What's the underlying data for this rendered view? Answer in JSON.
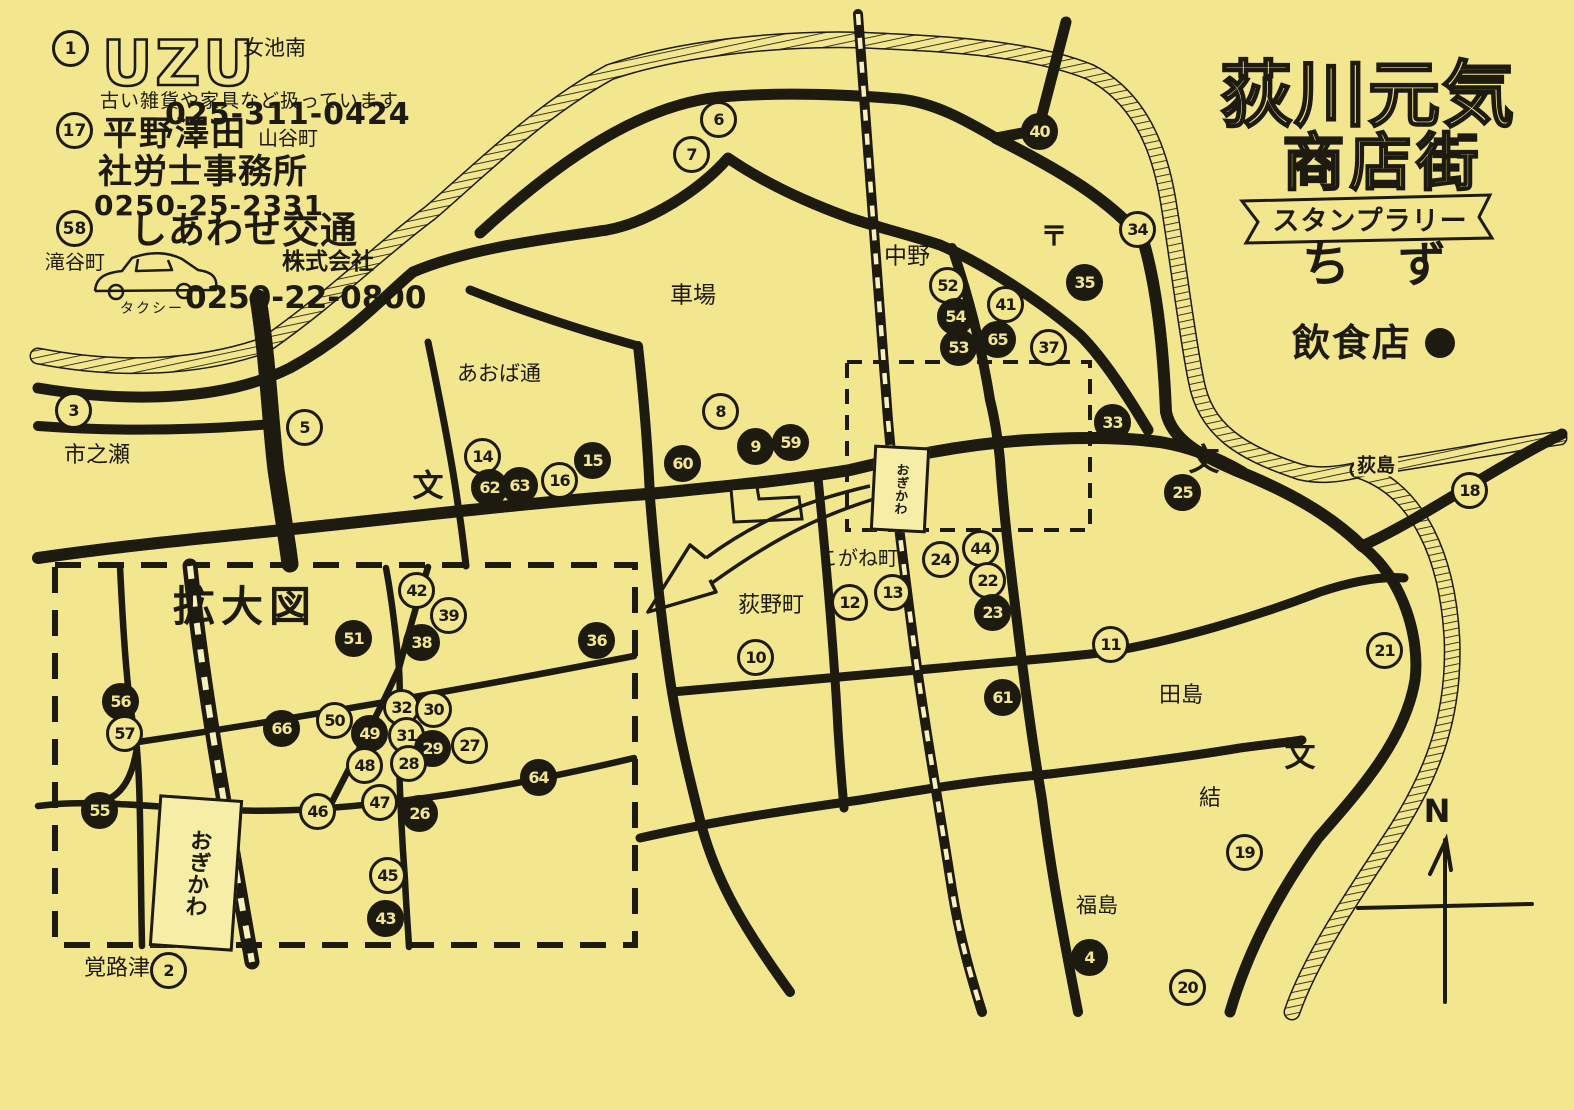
{
  "colors": {
    "paper": "#f2e68f",
    "ink": "#1d1a10"
  },
  "title": {
    "line1": "荻川元気",
    "line2": "商店街",
    "banner": "スタンプラリー",
    "map_word": "ち　ず",
    "food_legend": "飲食店"
  },
  "compass": {
    "letter": "N"
  },
  "station_main": "おぎかわ",
  "station_inset": "おぎかわ",
  "ads": [
    {
      "number": "1",
      "logo": "UZU",
      "area": "女池南",
      "desc": "古い雑貨や家具など扱っています",
      "phone": "025-311-0424"
    },
    {
      "number": "17",
      "name": "平野澤田",
      "area": "山谷町",
      "name2": "社労士事務所",
      "phone": "0250-25-2331"
    },
    {
      "number": "58",
      "name": "しあわせ交通",
      "name2": "株式会社",
      "area": "滝谷町",
      "vehicle": "タクシー",
      "phone": "0250-22-0800"
    }
  ],
  "markers": [
    {
      "n": "3",
      "x": 72,
      "y": 409,
      "filled": false
    },
    {
      "n": "5",
      "x": 303,
      "y": 426,
      "filled": false
    },
    {
      "n": "6",
      "x": 717,
      "y": 118,
      "filled": false
    },
    {
      "n": "7",
      "x": 690,
      "y": 153,
      "filled": false
    },
    {
      "n": "40",
      "x": 1038,
      "y": 130,
      "filled": true
    },
    {
      "n": "34",
      "x": 1136,
      "y": 228,
      "filled": false
    },
    {
      "n": "35",
      "x": 1083,
      "y": 281,
      "filled": true
    },
    {
      "n": "52",
      "x": 946,
      "y": 284,
      "filled": false
    },
    {
      "n": "54",
      "x": 954,
      "y": 315,
      "filled": true
    },
    {
      "n": "53",
      "x": 957,
      "y": 346,
      "filled": true
    },
    {
      "n": "41",
      "x": 1004,
      "y": 303,
      "filled": false
    },
    {
      "n": "65",
      "x": 996,
      "y": 338,
      "filled": true
    },
    {
      "n": "37",
      "x": 1047,
      "y": 346,
      "filled": false
    },
    {
      "n": "8",
      "x": 719,
      "y": 410,
      "filled": false
    },
    {
      "n": "14",
      "x": 481,
      "y": 455,
      "filled": false
    },
    {
      "n": "62",
      "x": 488,
      "y": 486,
      "filled": true
    },
    {
      "n": "63",
      "x": 518,
      "y": 484,
      "filled": true
    },
    {
      "n": "16",
      "x": 558,
      "y": 479,
      "filled": false
    },
    {
      "n": "15",
      "x": 591,
      "y": 459,
      "filled": true
    },
    {
      "n": "60",
      "x": 681,
      "y": 462,
      "filled": true
    },
    {
      "n": "9",
      "x": 754,
      "y": 445,
      "filled": true
    },
    {
      "n": "59",
      "x": 789,
      "y": 441,
      "filled": true
    },
    {
      "n": "33",
      "x": 1111,
      "y": 421,
      "filled": true
    },
    {
      "n": "25",
      "x": 1181,
      "y": 491,
      "filled": true
    },
    {
      "n": "18",
      "x": 1468,
      "y": 489,
      "filled": false
    },
    {
      "n": "44",
      "x": 979,
      "y": 547,
      "filled": false
    },
    {
      "n": "24",
      "x": 939,
      "y": 558,
      "filled": false
    },
    {
      "n": "22",
      "x": 986,
      "y": 579,
      "filled": false
    },
    {
      "n": "23",
      "x": 991,
      "y": 611,
      "filled": true
    },
    {
      "n": "13",
      "x": 891,
      "y": 591,
      "filled": false
    },
    {
      "n": "12",
      "x": 848,
      "y": 601,
      "filled": false
    },
    {
      "n": "10",
      "x": 754,
      "y": 656,
      "filled": false
    },
    {
      "n": "11",
      "x": 1109,
      "y": 643,
      "filled": false
    },
    {
      "n": "61",
      "x": 1001,
      "y": 696,
      "filled": true
    },
    {
      "n": "21",
      "x": 1383,
      "y": 649,
      "filled": false
    },
    {
      "n": "4",
      "x": 1088,
      "y": 956,
      "filled": true
    },
    {
      "n": "19",
      "x": 1243,
      "y": 851,
      "filled": false
    },
    {
      "n": "20",
      "x": 1186,
      "y": 986,
      "filled": false
    },
    {
      "n": "2",
      "x": 167,
      "y": 969,
      "filled": false
    },
    {
      "n": "42",
      "x": 415,
      "y": 589,
      "filled": false
    },
    {
      "n": "39",
      "x": 447,
      "y": 614,
      "filled": false
    },
    {
      "n": "51",
      "x": 352,
      "y": 637,
      "filled": true
    },
    {
      "n": "38",
      "x": 420,
      "y": 641,
      "filled": true
    },
    {
      "n": "36",
      "x": 595,
      "y": 639,
      "filled": true
    },
    {
      "n": "56",
      "x": 119,
      "y": 700,
      "filled": true
    },
    {
      "n": "57",
      "x": 123,
      "y": 732,
      "filled": false
    },
    {
      "n": "66",
      "x": 280,
      "y": 727,
      "filled": true
    },
    {
      "n": "50",
      "x": 333,
      "y": 719,
      "filled": false
    },
    {
      "n": "49",
      "x": 368,
      "y": 732,
      "filled": true
    },
    {
      "n": "32",
      "x": 400,
      "y": 706,
      "filled": false
    },
    {
      "n": "30",
      "x": 432,
      "y": 708,
      "filled": false
    },
    {
      "n": "31",
      "x": 405,
      "y": 734,
      "filled": false
    },
    {
      "n": "29",
      "x": 431,
      "y": 747,
      "filled": true
    },
    {
      "n": "27",
      "x": 468,
      "y": 744,
      "filled": false
    },
    {
      "n": "28",
      "x": 407,
      "y": 762,
      "filled": false
    },
    {
      "n": "48",
      "x": 363,
      "y": 764,
      "filled": false
    },
    {
      "n": "64",
      "x": 537,
      "y": 776,
      "filled": true
    },
    {
      "n": "46",
      "x": 316,
      "y": 810,
      "filled": false
    },
    {
      "n": "47",
      "x": 378,
      "y": 801,
      "filled": false
    },
    {
      "n": "26",
      "x": 418,
      "y": 812,
      "filled": true
    },
    {
      "n": "45",
      "x": 386,
      "y": 874,
      "filled": false
    },
    {
      "n": "43",
      "x": 384,
      "y": 917,
      "filled": true
    },
    {
      "n": "55",
      "x": 98,
      "y": 809,
      "filled": true
    }
  ],
  "labels": [
    {
      "text": "市之瀬",
      "x": 97,
      "y": 456,
      "size": 22
    },
    {
      "text": "あおば通",
      "x": 499,
      "y": 374,
      "size": 21
    },
    {
      "text": "車場",
      "x": 693,
      "y": 296,
      "size": 23
    },
    {
      "text": "中野",
      "x": 907,
      "y": 257,
      "size": 23
    },
    {
      "text": "〒",
      "x": 1054,
      "y": 237,
      "size": 27,
      "bold": true
    },
    {
      "text": "文",
      "x": 428,
      "y": 487,
      "size": 31,
      "bold": true
    },
    {
      "text": "文",
      "x": 1204,
      "y": 461,
      "size": 31,
      "bold": true
    },
    {
      "text": "文",
      "x": 1300,
      "y": 757,
      "size": 31,
      "bold": true
    },
    {
      "text": "荻島",
      "x": 1376,
      "y": 466,
      "size": 19,
      "bg": true,
      "bold": true
    },
    {
      "text": "こがね町",
      "x": 858,
      "y": 558,
      "size": 20
    },
    {
      "text": "荻野町",
      "x": 771,
      "y": 606,
      "size": 22
    },
    {
      "text": "田島",
      "x": 1181,
      "y": 696,
      "size": 22
    },
    {
      "text": "結",
      "x": 1210,
      "y": 799,
      "size": 22
    },
    {
      "text": "福島",
      "x": 1097,
      "y": 906,
      "size": 21
    },
    {
      "text": "覚路津",
      "x": 117,
      "y": 969,
      "size": 22
    },
    {
      "text": "拡大図",
      "x": 245,
      "y": 607,
      "size": 42,
      "bold": true,
      "ls": 6
    }
  ]
}
